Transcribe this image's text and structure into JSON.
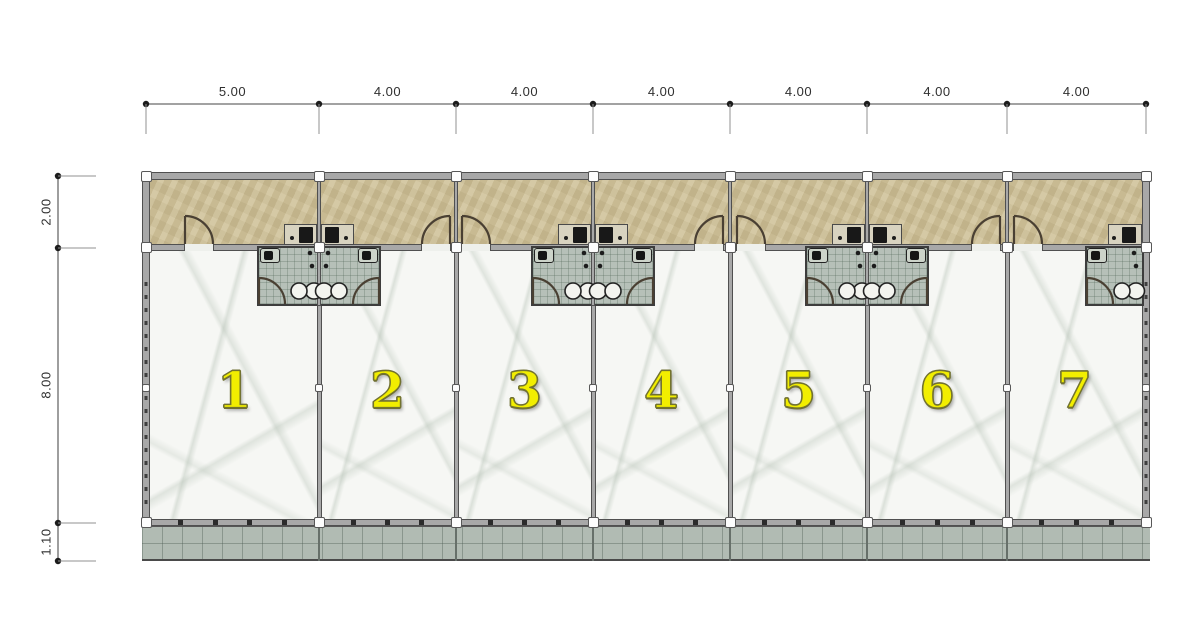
{
  "dimensions": {
    "top": [
      "5.00",
      "4.00",
      "4.00",
      "4.00",
      "4.00",
      "4.00",
      "4.00"
    ],
    "left": [
      "2.00",
      "8.00",
      "1.10"
    ]
  },
  "units": [
    {
      "number": "1"
    },
    {
      "number": "2"
    },
    {
      "number": "3"
    },
    {
      "number": "4"
    },
    {
      "number": "5"
    },
    {
      "number": "6"
    },
    {
      "number": "7"
    }
  ],
  "colors": {
    "corridor_floor": "#d2c59e",
    "marble_floor": "#f6f7f4",
    "bathroom_tile": "#b6c0b8",
    "terrace_paving": "#b1bbb3",
    "wall": "#a8a8a8",
    "unit_number": "#f2ee00",
    "dimension_text": "#2f2f2f"
  }
}
